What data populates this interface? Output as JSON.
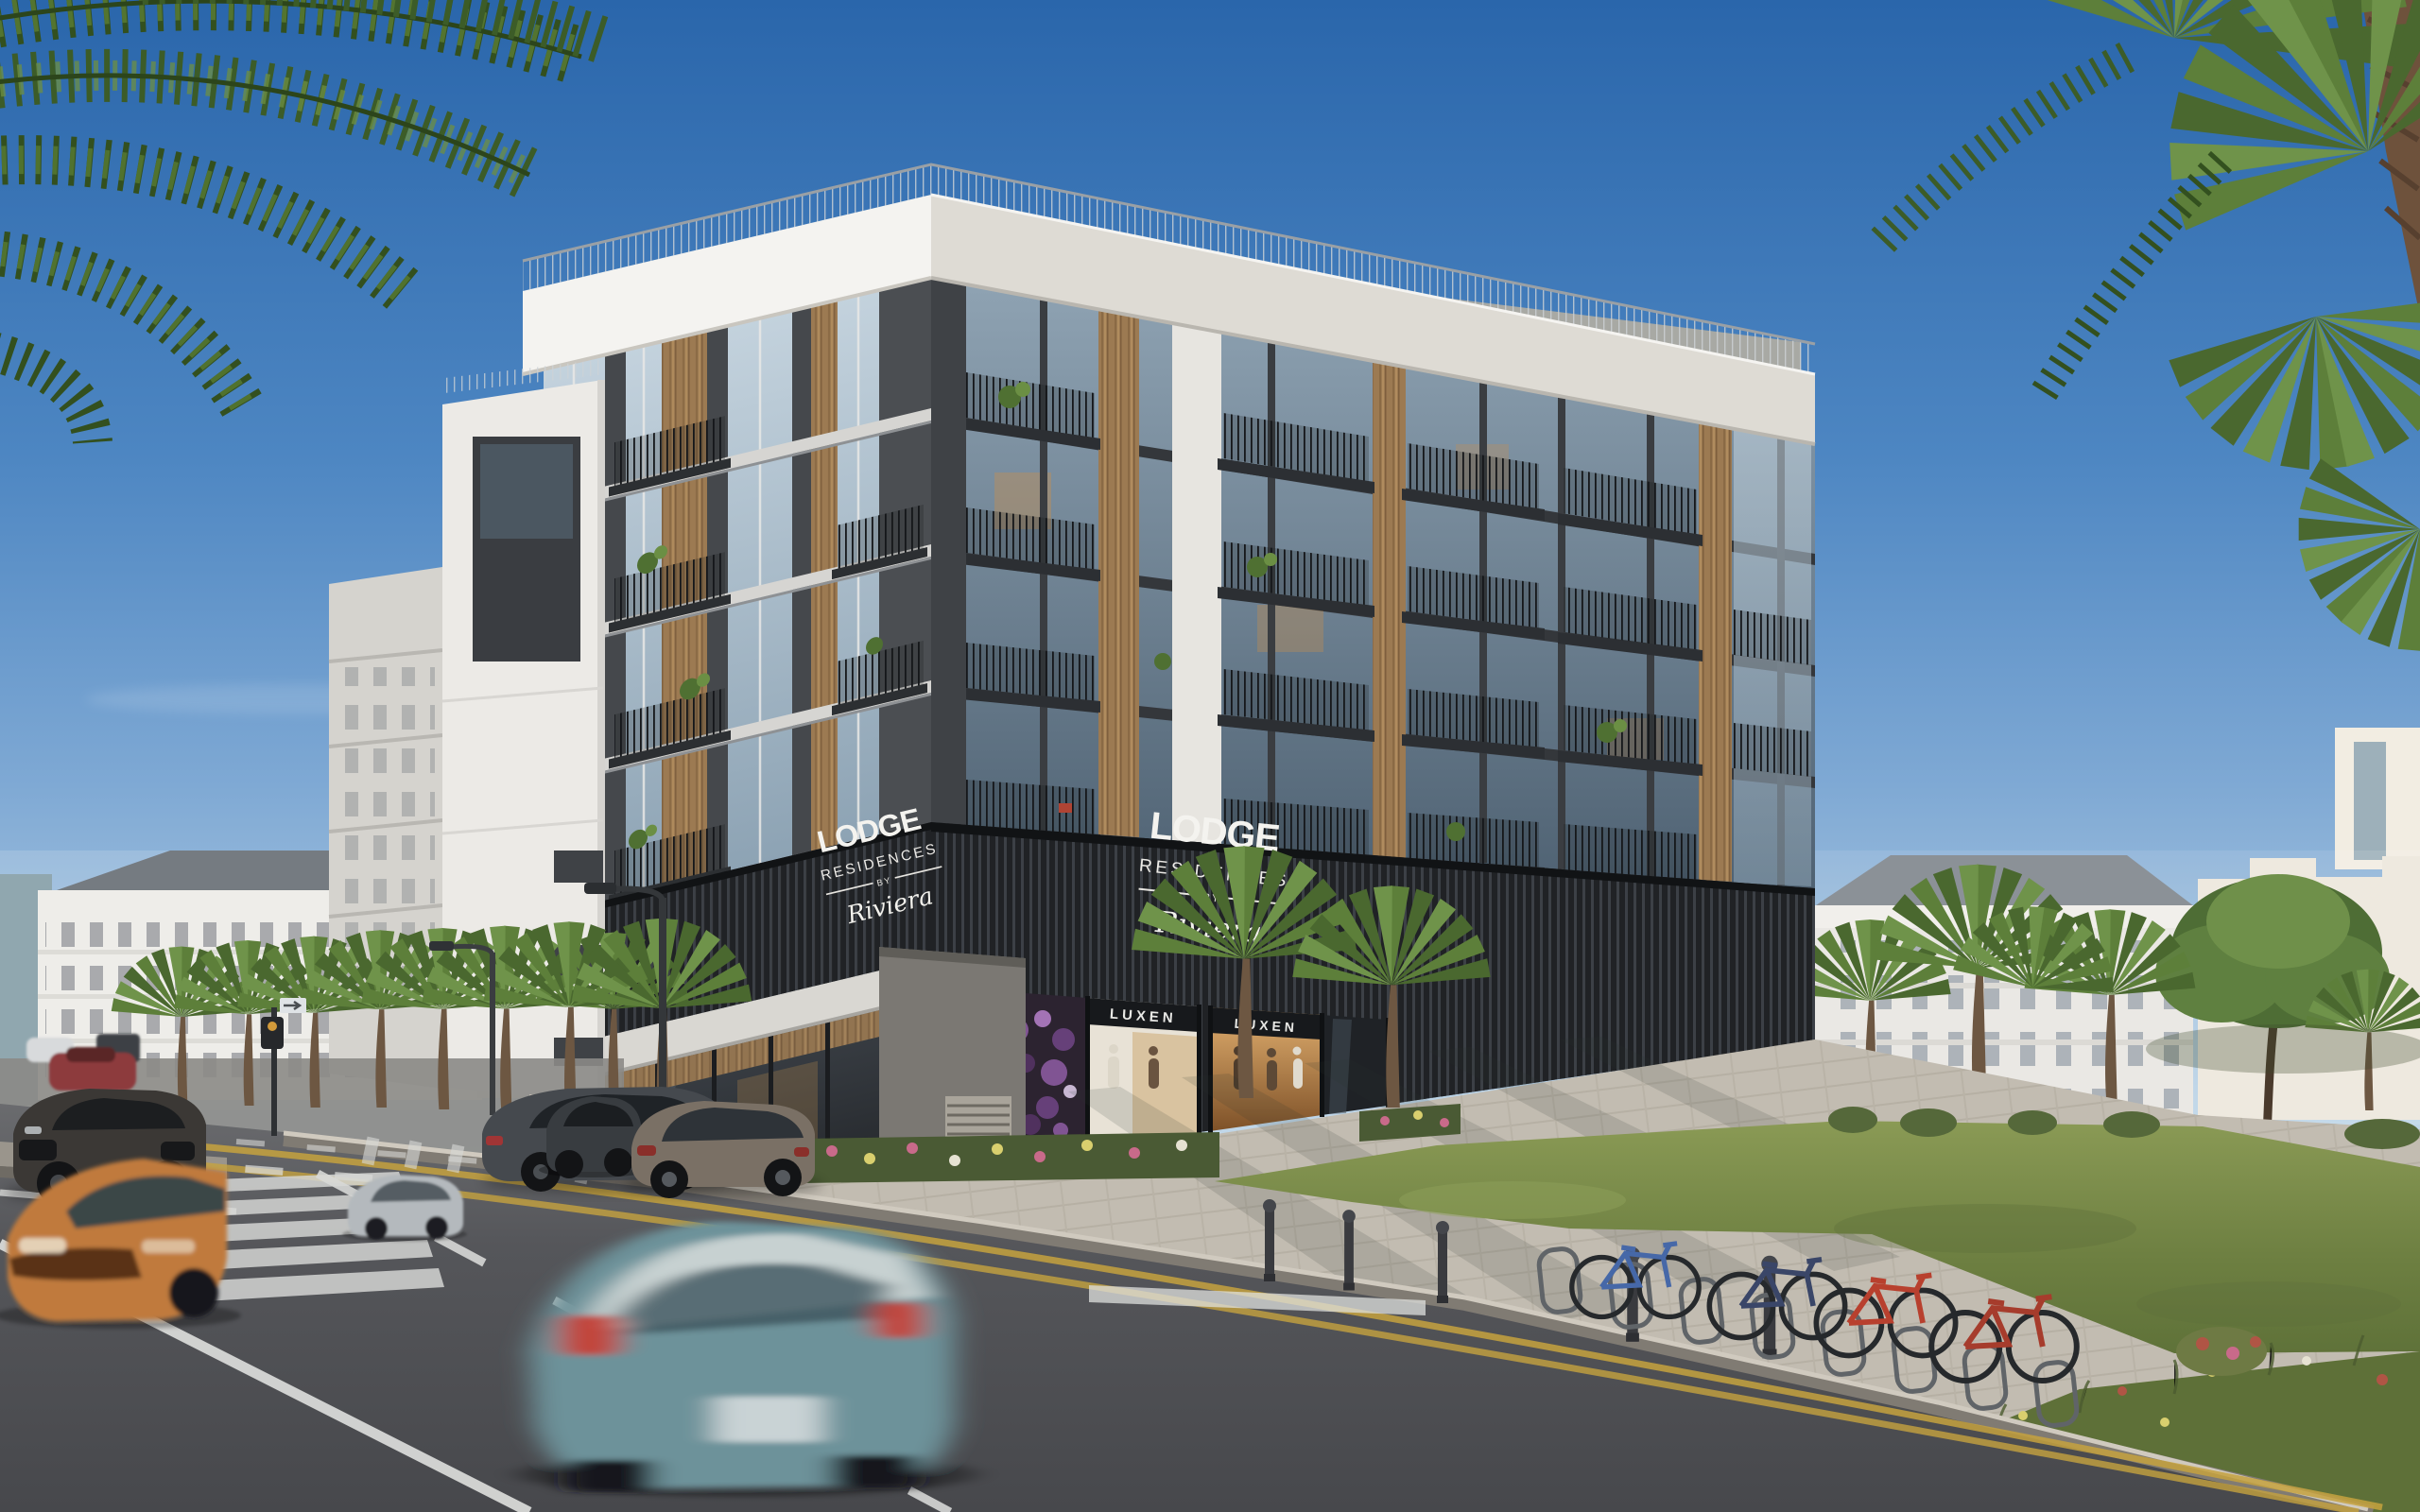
{
  "scene": {
    "caption": "Street-corner rendering of a modern six-storey apartment building with retail podium, palm-lined street, moving and parked cars, bicycles and lawns under a clear blue sky",
    "time_of_day": "daytime",
    "sky": "clear blue"
  },
  "signs": {
    "sign_west": {
      "title": "LODGE",
      "subtitle": "RESIDENCES",
      "connector": "BY",
      "brand": "Riviera"
    },
    "sign_south": {
      "title": "LODGE",
      "subtitle": "RESIDENCES",
      "connector": "BY",
      "brand": "Riviera"
    },
    "shop": {
      "left": "LUXEN",
      "right": "LUXEN"
    }
  },
  "building": {
    "floors_visible": 6,
    "podium": "dark slatted retail base with illuminated shopfronts and mannequins",
    "materials": [
      "white cornice frame",
      "grey stone",
      "dark grey panels",
      "timber slat accents",
      "glass balconies"
    ]
  },
  "palette": {
    "sky_top": "#2a66ab",
    "sky_mid": "#7fa9d4",
    "sky_horizon": "#dde9f1",
    "cornice_white": "#f4f3f0",
    "facade_light_grey": "#b6b9bc",
    "facade_dark_grey": "#5a5d61",
    "podium_slat_dark": "#202225",
    "timber_accent": "#9c7a52",
    "glass_cool": "#8fa3b3",
    "shop_glow_amber": "#d9a05c",
    "display_purple": "#8a5a9e",
    "road_asphalt": "#55565a",
    "lane_white": "#dfe0de",
    "lane_yellow": "#c5a23e",
    "paving": "#c2bcb1",
    "grass": "#6d7f41"
  },
  "vehicles": [
    {
      "kind": "parked-dark-suv",
      "color": "#3b3835"
    },
    {
      "kind": "red-sedan-distant",
      "color": "#8d3a3c"
    },
    {
      "kind": "silver-sedan",
      "color": "#b4b9bd"
    },
    {
      "kind": "dark-grey-sedan",
      "color": "#45494e"
    },
    {
      "kind": "parked-black-sedan",
      "color": "#383c40"
    },
    {
      "kind": "parked-bronze-suv",
      "color": "#7a7065"
    },
    {
      "kind": "orange-sports-car",
      "color": "#c07a3c"
    },
    {
      "kind": "teal-sedan-motion-blur",
      "color": "#6d929a"
    }
  ],
  "street_furniture": {
    "bicycles": 4,
    "bollards": 5,
    "street_palms": 8,
    "bike_racks": 8,
    "street_lamps": 2,
    "traffic_signal": 1
  }
}
